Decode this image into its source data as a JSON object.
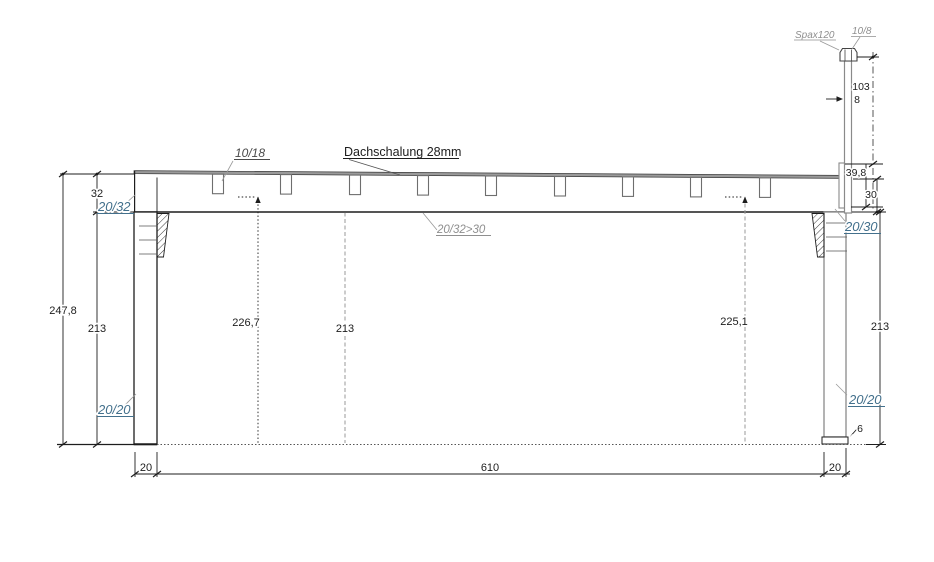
{
  "colors": {
    "line": "#1d1d1d",
    "gray_line": "#8a8a8a",
    "annotation_blue": "#43708c",
    "annotation_gray": "#8f8f8f"
  },
  "drawing": {
    "roof": {
      "rafter_label": "10/18",
      "sheathing_label": "Dachschalung 28mm",
      "beam_label": "20/32>30"
    },
    "left": {
      "beam_height": "32",
      "total_height": "247,8",
      "post_height": "213",
      "bracket_label": "20/32",
      "post_label": "20/20"
    },
    "clearances": {
      "left": "226,7",
      "center": "213",
      "right": "225,1"
    },
    "right": {
      "post_height": "213",
      "bracket_label": "20/30",
      "post_label": "20/20",
      "foot_height": "6"
    },
    "top_right": {
      "screw_label": "Spax120",
      "cap_label": "10/8",
      "board_thickness": "8",
      "board_height": "103",
      "upstand_height": "39,8",
      "beam_height": "30"
    },
    "bottom": {
      "left_post_width": "20",
      "span": "610",
      "right_post_width": "20"
    }
  }
}
